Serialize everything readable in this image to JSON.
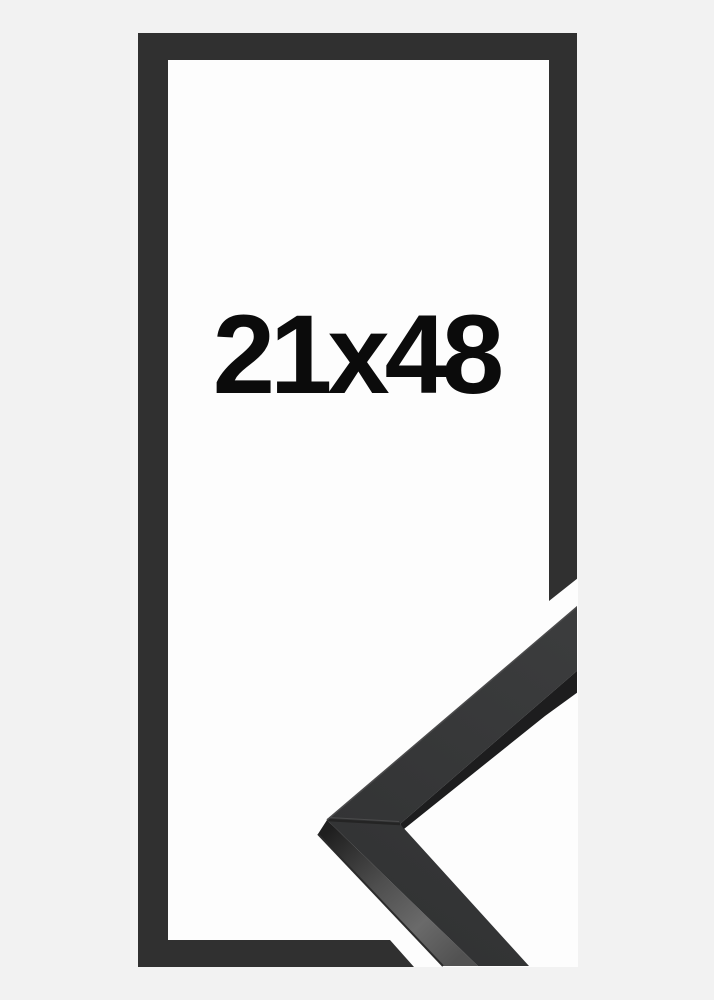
{
  "product": {
    "size_label": "21x48",
    "description": "black picture frame with corner profile sample"
  },
  "colors": {
    "background": "#f2f2f2",
    "inner_area": "#fdfdfd",
    "frame_outline": "#303030",
    "label_text": "#0b0b0b",
    "sample_top_face_light": "#3b3c3d",
    "sample_top_face_dark": "#323334",
    "sample_edge_shadow": "#1d1d1e",
    "sample_side_near": "#1f1f1f",
    "sample_side_mid": "#4e4e4e",
    "sample_side_light": "#6a6a6a",
    "sample_side_far": "#525252",
    "sample_side_edge_line": "#2b2b2b",
    "seam": "#242424",
    "edge_highlight": "#4b4b4c"
  }
}
